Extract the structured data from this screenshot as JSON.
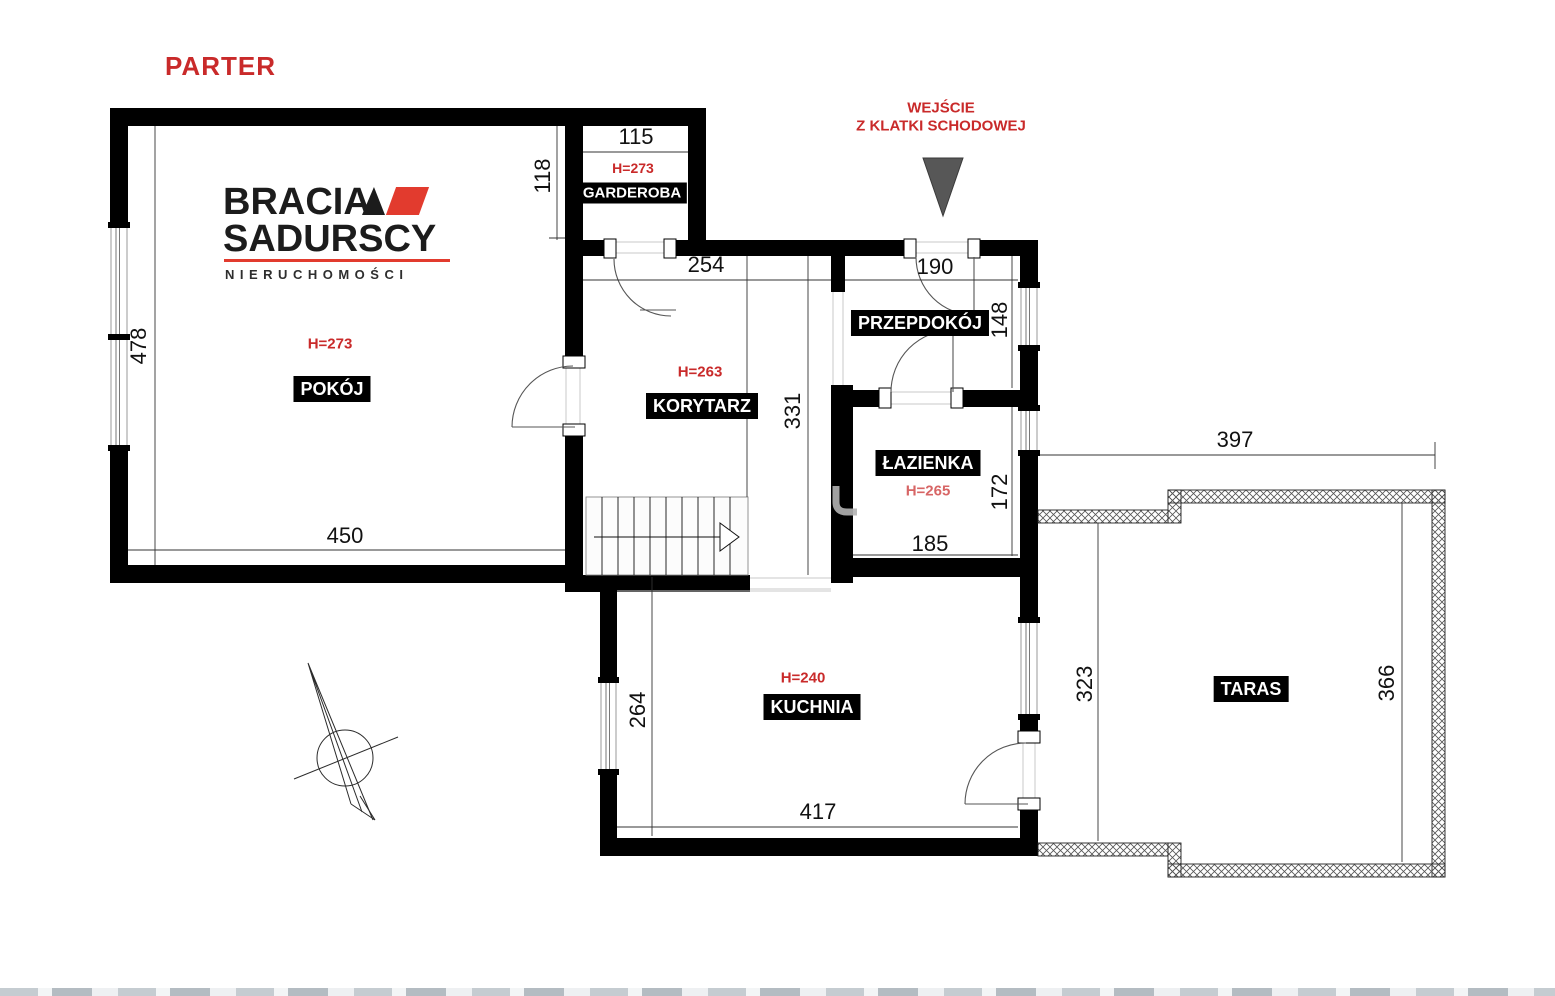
{
  "title": "PARTER",
  "entrance": {
    "line1": "WEJŚCIE",
    "line2": "Z KLATKI SCHODOWEJ"
  },
  "logo": {
    "brand_line1": "BRACIA",
    "brand_line2": "SADURSCY",
    "tagline": "NIERUCHOMOŚCI"
  },
  "rooms": {
    "garderoba": {
      "label": "GARDEROBA",
      "ceiling_height": "H=273",
      "width_cm": "115",
      "depth_cm": "118"
    },
    "pokoj": {
      "label": "POKÓJ",
      "ceiling_height": "H=273",
      "width_cm": "450",
      "depth_cm": "478"
    },
    "korytarz": {
      "label": "KORYTARZ",
      "ceiling_height": "H=263",
      "width_cm": "254",
      "depth_cm": "331"
    },
    "przedpokoj": {
      "label": "PRZEPDOKÓJ",
      "width_cm": "190",
      "depth_cm": "148"
    },
    "lazienka": {
      "label": "ŁAZIENKA",
      "ceiling_height": "H=265",
      "width_cm": "185",
      "depth_cm": "172"
    },
    "kuchnia": {
      "label": "KUCHNIA",
      "ceiling_height": "H=240",
      "width_cm": "417",
      "depth_cm": "264"
    },
    "taras": {
      "label": "TARAS",
      "width_cm": "397",
      "depth_left_cm": "323",
      "depth_right_cm": "366"
    }
  },
  "colors": {
    "accent_red": "#c92a2a",
    "logo_red": "#e23b2e",
    "wall": "#000000",
    "entrance_arrow": "#575757"
  }
}
